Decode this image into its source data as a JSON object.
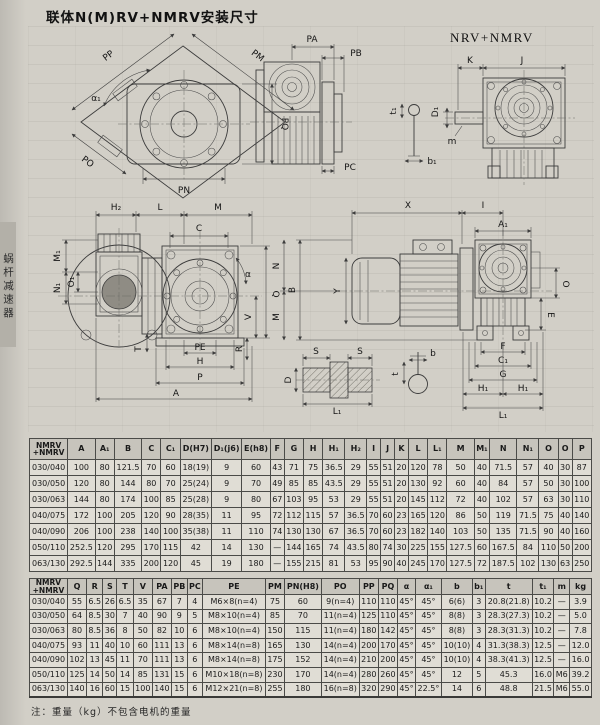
{
  "titles": {
    "page": "联体N(M)RV+NMRV安装尺寸",
    "nrv": "NRV+NMRV",
    "side_tab": "蜗杆减速器",
    "note": "注：重量（kg）不包含电机的重量"
  },
  "labels": {
    "pp": "PP",
    "pm": "PM",
    "pq": "PQ",
    "po": "PO",
    "pn": "PN",
    "alpha1": "α₁",
    "pa": "PA",
    "pb": "PB",
    "pc": "PC",
    "t1": "t₁",
    "b1": "b₁",
    "k": "K",
    "j": "J",
    "d1": "D₁",
    "m": "m",
    "h2": "H₂",
    "l": "L",
    "mcap": "M",
    "c": "C",
    "m1": "M₁",
    "o1": "O₁",
    "n1": "N₁",
    "alpha": "α",
    "q": "Q",
    "v": "V",
    "r": "R",
    "tcap": "T",
    "pe": "PE",
    "h": "H",
    "p": "P",
    "a": "A",
    "x": "X",
    "i": "I",
    "a1": "A₁",
    "y": "Y",
    "n": "N",
    "bcap": "B",
    "o": "O",
    "e": "E",
    "f": "F",
    "c1": "C₁",
    "g": "G",
    "h1": "H₁",
    "l1": "L₁",
    "s": "S",
    "d": "D",
    "b": "b",
    "t": "t"
  },
  "table1": {
    "headers": [
      "NMRV\n+NMRV",
      "A",
      "A₁",
      "B",
      "C",
      "C₁",
      "D(H7)",
      "D₁(j6)",
      "E(h8)",
      "F",
      "G",
      "H",
      "H₁",
      "H₂",
      "I",
      "J",
      "K",
      "L",
      "L₁",
      "M",
      "M₁",
      "N",
      "N₁",
      "O",
      "O",
      "P"
    ],
    "rows": [
      [
        "030/040",
        "100",
        "80",
        "121.5",
        "70",
        "60",
        "18(19)",
        "9",
        "60",
        "43",
        "71",
        "75",
        "36.5",
        "29",
        "55",
        "51",
        "20",
        "120",
        "78",
        "50",
        "40",
        "71.5",
        "57",
        "40",
        "30",
        "87"
      ],
      [
        "030/050",
        "120",
        "80",
        "144",
        "80",
        "70",
        "25(24)",
        "9",
        "70",
        "49",
        "85",
        "85",
        "43.5",
        "29",
        "55",
        "51",
        "20",
        "130",
        "92",
        "60",
        "40",
        "84",
        "57",
        "50",
        "30",
        "100"
      ],
      [
        "030/063",
        "144",
        "80",
        "174",
        "100",
        "85",
        "25(28)",
        "9",
        "80",
        "67",
        "103",
        "95",
        "53",
        "29",
        "55",
        "51",
        "20",
        "145",
        "112",
        "72",
        "40",
        "102",
        "57",
        "63",
        "30",
        "110"
      ],
      [
        "040/075",
        "172",
        "100",
        "205",
        "120",
        "90",
        "28(35)",
        "11",
        "95",
        "72",
        "112",
        "115",
        "57",
        "36.5",
        "70",
        "60",
        "23",
        "165",
        "120",
        "86",
        "50",
        "119",
        "71.5",
        "75",
        "40",
        "140"
      ],
      [
        "040/090",
        "206",
        "100",
        "238",
        "140",
        "100",
        "35(38)",
        "11",
        "110",
        "74",
        "130",
        "130",
        "67",
        "36.5",
        "70",
        "60",
        "23",
        "182",
        "140",
        "103",
        "50",
        "135",
        "71.5",
        "90",
        "40",
        "160"
      ],
      [
        "050/110",
        "252.5",
        "120",
        "295",
        "170",
        "115",
        "42",
        "14",
        "130",
        "—",
        "144",
        "165",
        "74",
        "43.5",
        "80",
        "74",
        "30",
        "225",
        "155",
        "127.5",
        "60",
        "167.5",
        "84",
        "110",
        "50",
        "200"
      ],
      [
        "063/130",
        "292.5",
        "144",
        "335",
        "200",
        "120",
        "45",
        "19",
        "180",
        "—",
        "155",
        "215",
        "81",
        "53",
        "95",
        "90",
        "40",
        "245",
        "170",
        "127.5",
        "72",
        "187.5",
        "102",
        "130",
        "63",
        "250"
      ]
    ]
  },
  "table2": {
    "headers": [
      "NMRV\n+NMRV",
      "Q",
      "R",
      "S",
      "T",
      "V",
      "PA",
      "PB",
      "PC",
      "PE",
      "PM",
      "PN(H8)",
      "PO",
      "PP",
      "PQ",
      "α",
      "α₁",
      "b",
      "b₁",
      "t",
      "t₁",
      "m",
      "kg"
    ],
    "rows": [
      [
        "030/040",
        "55",
        "6.5",
        "26",
        "6.5",
        "35",
        "67",
        "7",
        "4",
        "M6×8(n=4)",
        "75",
        "60",
        "9(n=4)",
        "110",
        "110",
        "45°",
        "45°",
        "6(6)",
        "3",
        "20.8(21.8)",
        "10.2",
        "—",
        "3.9"
      ],
      [
        "030/050",
        "64",
        "8.5",
        "30",
        "7",
        "40",
        "90",
        "9",
        "5",
        "M8×10(n=4)",
        "85",
        "70",
        "11(n=4)",
        "125",
        "110",
        "45°",
        "45°",
        "8(8)",
        "3",
        "28.3(27.3)",
        "10.2",
        "—",
        "5.0"
      ],
      [
        "030/063",
        "80",
        "8.5",
        "36",
        "8",
        "50",
        "82",
        "10",
        "6",
        "M8×10(n=4)",
        "150",
        "115",
        "11(n=4)",
        "180",
        "142",
        "45°",
        "45°",
        "8(8)",
        "3",
        "28.3(31.3)",
        "10.2",
        "—",
        "7.8"
      ],
      [
        "040/075",
        "93",
        "11",
        "40",
        "10",
        "60",
        "111",
        "13",
        "6",
        "M8×14(n=8)",
        "165",
        "130",
        "14(n=4)",
        "200",
        "170",
        "45°",
        "45°",
        "10(10)",
        "4",
        "31.3(38.3)",
        "12.5",
        "—",
        "12.0"
      ],
      [
        "040/090",
        "102",
        "13",
        "45",
        "11",
        "70",
        "111",
        "13",
        "6",
        "M8×14(n=8)",
        "175",
        "152",
        "14(n=4)",
        "210",
        "200",
        "45°",
        "45°",
        "10(10)",
        "4",
        "38.3(41.3)",
        "12.5",
        "—",
        "16.0"
      ],
      [
        "050/110",
        "125",
        "14",
        "50",
        "14",
        "85",
        "131",
        "15",
        "6",
        "M10×18(n=8)",
        "230",
        "170",
        "14(n=4)",
        "280",
        "260",
        "45°",
        "45°",
        "12",
        "5",
        "45.3",
        "16.0",
        "M6",
        "39.2"
      ],
      [
        "063/130",
        "140",
        "16",
        "60",
        "15",
        "100",
        "140",
        "15",
        "6",
        "M12×21(n=8)",
        "255",
        "180",
        "16(n=8)",
        "320",
        "290",
        "45°",
        "22.5°",
        "14",
        "6",
        "48.8",
        "21.5",
        "M6",
        "55.0"
      ]
    ]
  }
}
